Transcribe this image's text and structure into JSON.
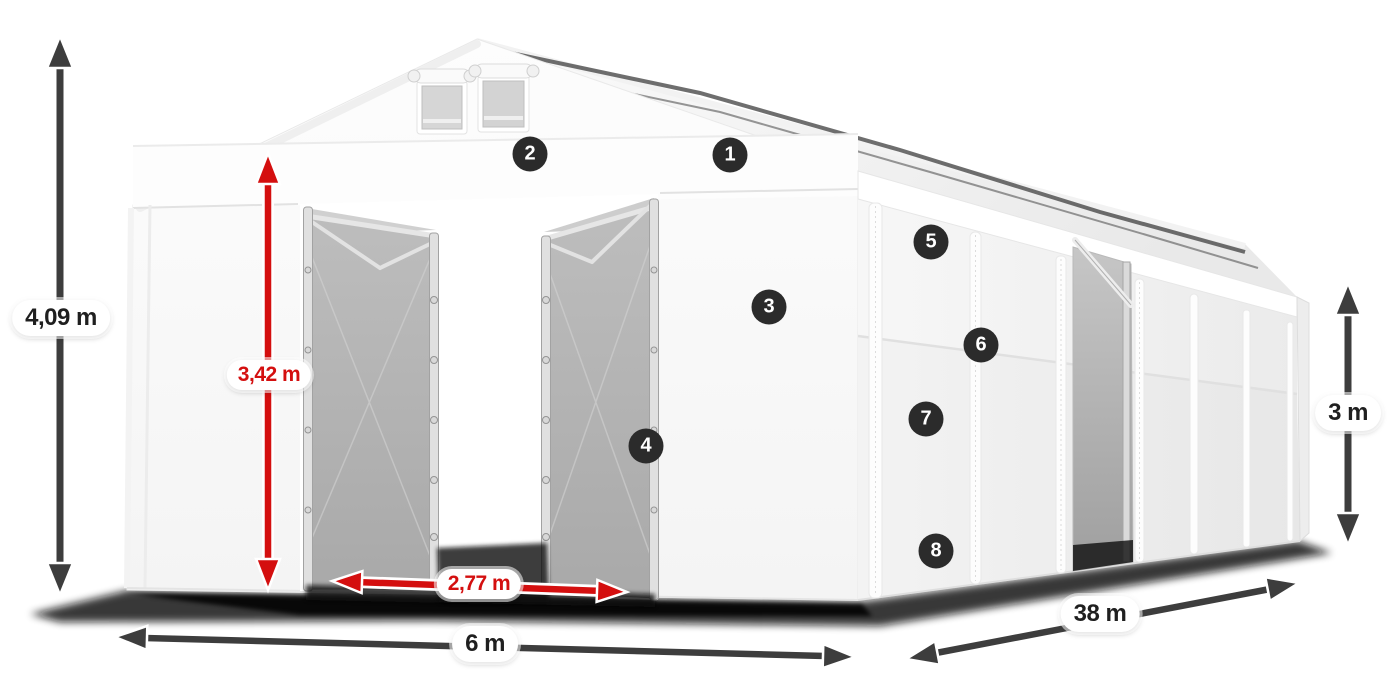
{
  "dimensions": [
    {
      "id": "total-height",
      "label": "4,09 m",
      "style": "dark"
    },
    {
      "id": "entrance-height",
      "label": "3,42 m",
      "style": "red"
    },
    {
      "id": "entrance-width",
      "label": "2,77 m",
      "style": "red"
    },
    {
      "id": "total-width",
      "label": "6 m",
      "style": "dark"
    },
    {
      "id": "total-length",
      "label": "38 m",
      "style": "dark"
    },
    {
      "id": "side-height",
      "label": "3 m",
      "style": "dark"
    }
  ],
  "markers": [
    {
      "number": "1"
    },
    {
      "number": "2"
    },
    {
      "number": "3"
    },
    {
      "number": "4"
    },
    {
      "number": "5"
    },
    {
      "number": "6"
    },
    {
      "number": "7"
    },
    {
      "number": "8"
    }
  ],
  "colors": {
    "dim_red": "#d40f0f",
    "dim_dark": "#3d3d3d",
    "badge_bg": "#2b2b2b",
    "badge_text": "#ffffff",
    "label_bg": "#ffffff",
    "label_text": "#1f1f1f"
  }
}
